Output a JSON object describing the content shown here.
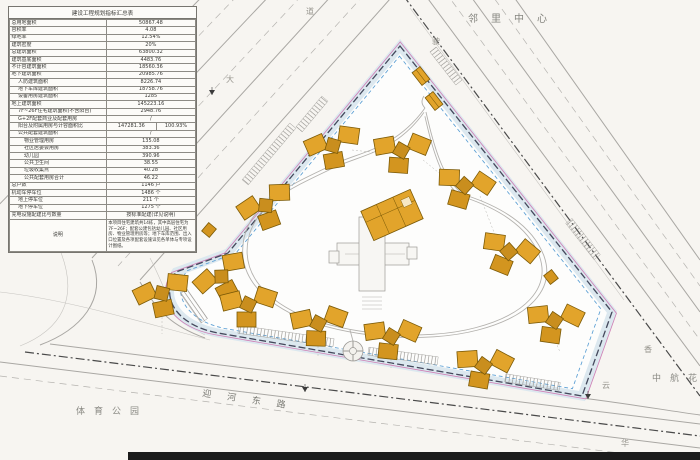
{
  "indicator_table": {
    "title": "建设工程规划指标汇总表",
    "rows": [
      {
        "l": "总用地面积",
        "v": "50867.48"
      },
      {
        "l": "容积率",
        "v": "4.08"
      },
      {
        "l": "绿地率",
        "v": "12.54%"
      },
      {
        "l": "建筑密度",
        "v": "20%"
      },
      {
        "l": "总建筑面积",
        "v": "63800.32"
      },
      {
        "l": "建筑基底面积",
        "v": "4483.76"
      },
      {
        "l": "不计容建筑面积",
        "v": "18560.36"
      },
      {
        "l": "地下建筑面积",
        "v": "20985.76"
      },
      {
        "l": "人防建筑面积",
        "v": "8226.74",
        "ind": 1
      },
      {
        "l": "地下车库建筑面积",
        "v": "18758.76",
        "ind": 1
      },
      {
        "l": "设备用房建筑面积",
        "v": "1285",
        "ind": 1
      },
      {
        "l": "地上建筑面积",
        "v": "145223.16"
      },
      {
        "l": "7F~26F住宅建筑面积(不含阳台)",
        "v": "2948.76",
        "ind": 1
      },
      {
        "l": "G+2F配套商业及配套用房",
        "v": "/",
        "ind": 1
      },
      {
        "l": "阳台及附属用房与计容面积比",
        "v": "147281.36",
        "v2": "100.93%",
        "ind": 1
      },
      {
        "l": "公共配套建筑面积",
        "v": "/",
        "ind": 1
      },
      {
        "l": "物业管理用房",
        "v": "135.08",
        "ind": 2
      },
      {
        "l": "社区居委会用房",
        "v": "383.36",
        "ind": 2
      },
      {
        "l": "幼儿园",
        "v": "390.96",
        "ind": 2
      },
      {
        "l": "公共卫生间",
        "v": "38.55",
        "ind": 2
      },
      {
        "l": "垃圾收集点",
        "v": "40.28",
        "ind": 2
      },
      {
        "l": "公共配套用房合计",
        "v": "46.22",
        "ind": 2
      },
      {
        "l": "总户数",
        "v": "1146 户"
      },
      {
        "l": "机动车停车位",
        "v": "1486 个"
      },
      {
        "l": "地上停车位",
        "v": "211 个",
        "ind": 1
      },
      {
        "l": "地下停车位",
        "v": "1275 个",
        "ind": 1
      },
      {
        "l": "充电设施配建比与数量",
        "v": "按标准配建(详见说明)"
      }
    ],
    "note_label": "说明",
    "note": "本项目住宅建筑共14栋，其中高层住宅为7F~26F；配套公建包括幼儿园、社区用房、物业管理用房等；地下车库范围、出入口位置及各项配套设施详见各单体与专项设计图纸。"
  },
  "labels": {
    "neighborhood_center": "邻里中心",
    "sports_park": "体育公园",
    "avic_garden": "中航花",
    "river_east_road": "迎河东路",
    "road_char_1": "道",
    "road_char_2": "大",
    "road_char_3": "驶",
    "road_char_4": "香",
    "road_char_5": "云",
    "road_char_6": "华"
  },
  "site_plan": {
    "colors": {
      "building_fill": "#E2A42B",
      "building_stroke": "#7B5A07",
      "boundary": "#44485C",
      "red_line": "#4A4A4A",
      "blue_dashed_line": "#5B9FD4",
      "magenta_line": "#CF7FB5",
      "road_line": "#A9A7A3"
    },
    "buildings": [
      {
        "t": "tower",
        "x": 333,
        "y": 147,
        "r": -6
      },
      {
        "t": "tower",
        "x": 401,
        "y": 152,
        "r": 8
      },
      {
        "t": "tower",
        "x": 464,
        "y": 187,
        "r": 20
      },
      {
        "t": "tower",
        "x": 508,
        "y": 253,
        "r": 26
      },
      {
        "t": "tower",
        "x": 554,
        "y": 322,
        "r": 12
      },
      {
        "t": "tower",
        "x": 266,
        "y": 207,
        "r": -16
      },
      {
        "t": "tower",
        "x": 222,
        "y": 278,
        "r": -24
      },
      {
        "t": "tower",
        "x": 162,
        "y": 295,
        "r": -8
      },
      {
        "t": "tower",
        "x": 248,
        "y": 306,
        "r": 4
      },
      {
        "t": "tower",
        "x": 318,
        "y": 325,
        "r": 6
      },
      {
        "t": "tower",
        "x": 391,
        "y": 338,
        "r": 10
      },
      {
        "t": "tower",
        "x": 483,
        "y": 367,
        "r": 14
      },
      {
        "t": "kindergarten",
        "x": 392,
        "y": 215,
        "r": -24
      },
      {
        "t": "gate",
        "x": 421,
        "y": 76,
        "r": 52
      },
      {
        "t": "gate",
        "x": 434,
        "y": 101,
        "r": 52
      },
      {
        "t": "utility",
        "x": 209,
        "y": 230,
        "r": -50
      },
      {
        "t": "utility",
        "x": 551,
        "y": 277,
        "r": 52
      },
      {
        "t": "marker",
        "x": 212,
        "y": 95,
        "r": 0
      },
      {
        "t": "marker",
        "x": 305,
        "y": 392,
        "r": 0
      },
      {
        "t": "marker",
        "x": 588,
        "y": 399,
        "r": 0
      }
    ]
  }
}
